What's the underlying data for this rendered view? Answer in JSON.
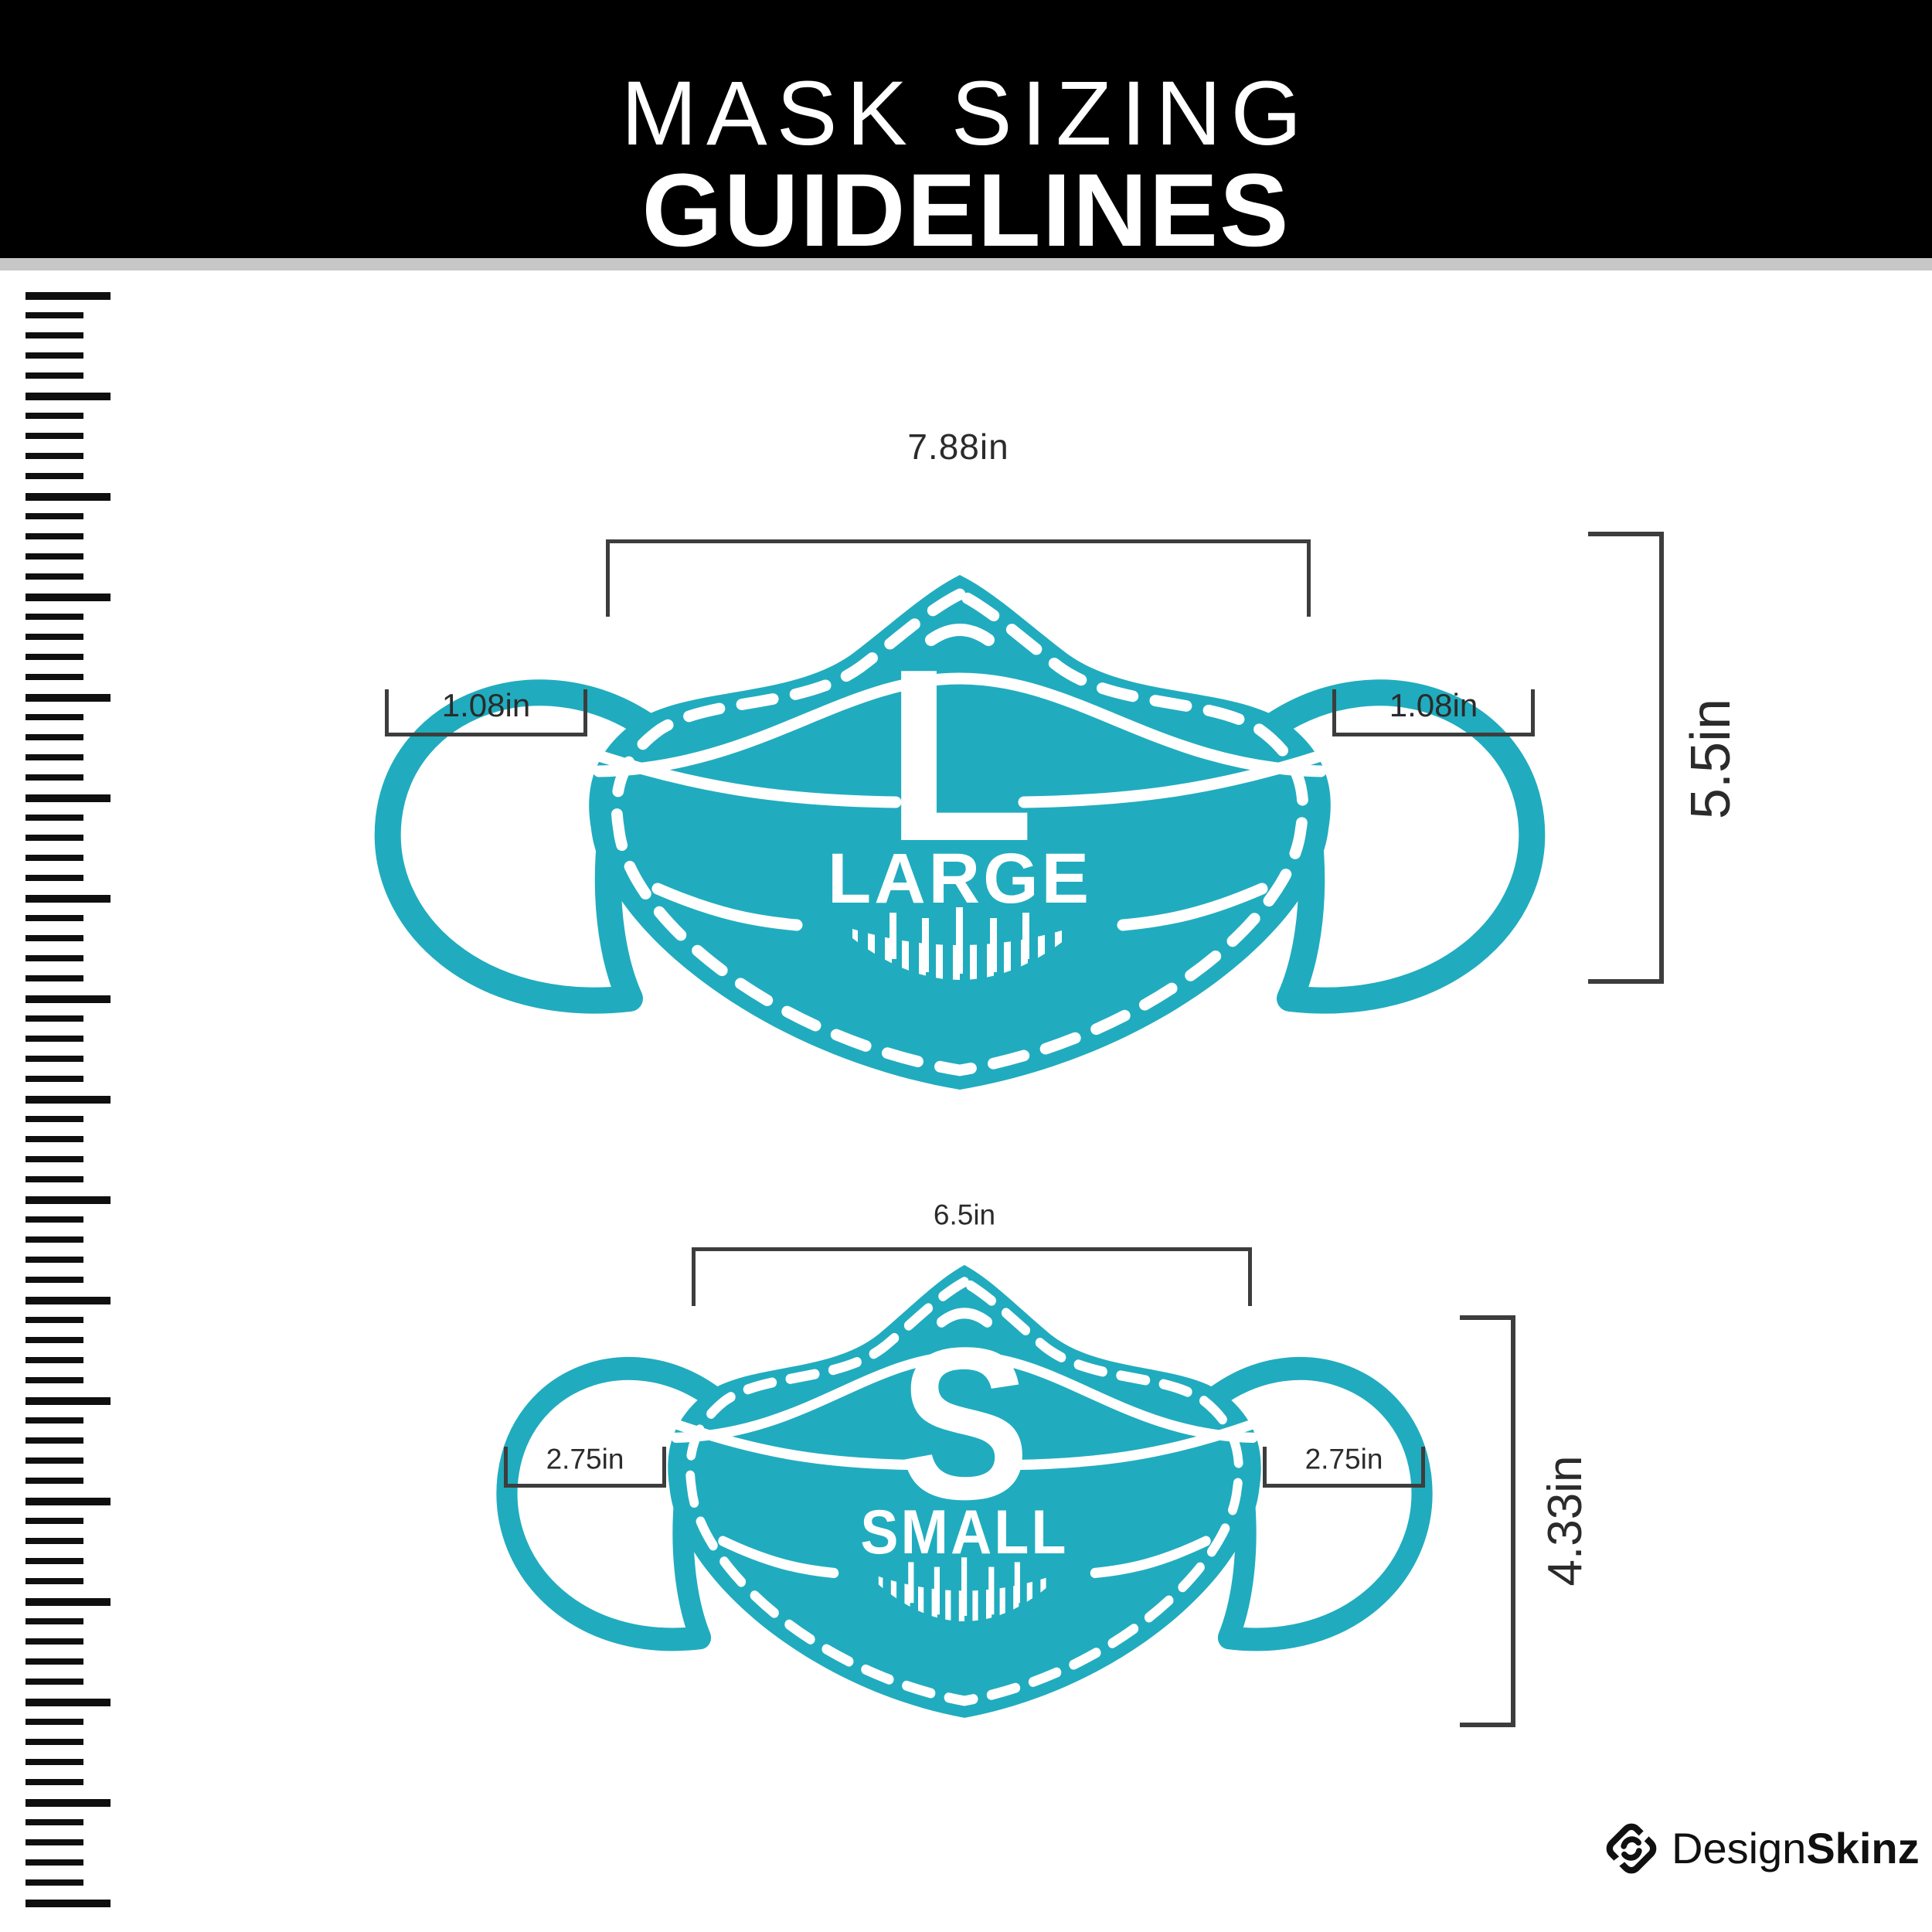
{
  "header": {
    "title_line1": "MASK SIZING",
    "title_line2": "GUIDELINES"
  },
  "colors": {
    "teal": "#20ACBE",
    "header_bg": "#000000",
    "gray_strip": "#C7C7C7",
    "bracket": "#3D3D3D",
    "label_text": "#2B2B2B",
    "ruler_tick": "#0F0F0F",
    "brand_text": "#101010",
    "mask_detail": "#FFFFFF"
  },
  "masks": [
    {
      "id": "large",
      "letter": "L",
      "name": "LARGE",
      "width_label": "7.88in",
      "height_label": "5.5in",
      "ear_label_left": "1.08in",
      "ear_label_right": "1.08in"
    },
    {
      "id": "small",
      "letter": "S",
      "name": "SMALL",
      "width_label": "6.5in",
      "height_label": "4.33in",
      "ear_label_left": "2.75in",
      "ear_label_right": "2.75in"
    }
  ],
  "footer": {
    "brand_regular": "Design",
    "brand_bold": "Skinz"
  },
  "icons": {
    "ruler": "ruler-icon",
    "brand": "designskinz-diamond-icon",
    "mask": "face-mask-icon"
  }
}
